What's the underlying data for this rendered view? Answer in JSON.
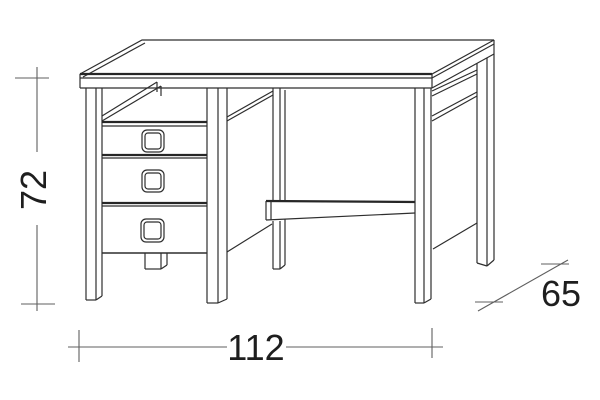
{
  "diagram": {
    "kind": "furniture-dimension-drawing",
    "object": "desk-with-drawer-pedestal",
    "dimensions": {
      "height": {
        "label": "72",
        "orientation": "vertical"
      },
      "width": {
        "label": "112",
        "orientation": "horizontal"
      },
      "depth": {
        "label": "65",
        "orientation": "diagonal"
      }
    },
    "colors": {
      "background": "#ffffff",
      "drawing_line": "#2e2e2e",
      "dimension_line": "#5f5f5f",
      "label_text": "#1e1e1e"
    }
  }
}
